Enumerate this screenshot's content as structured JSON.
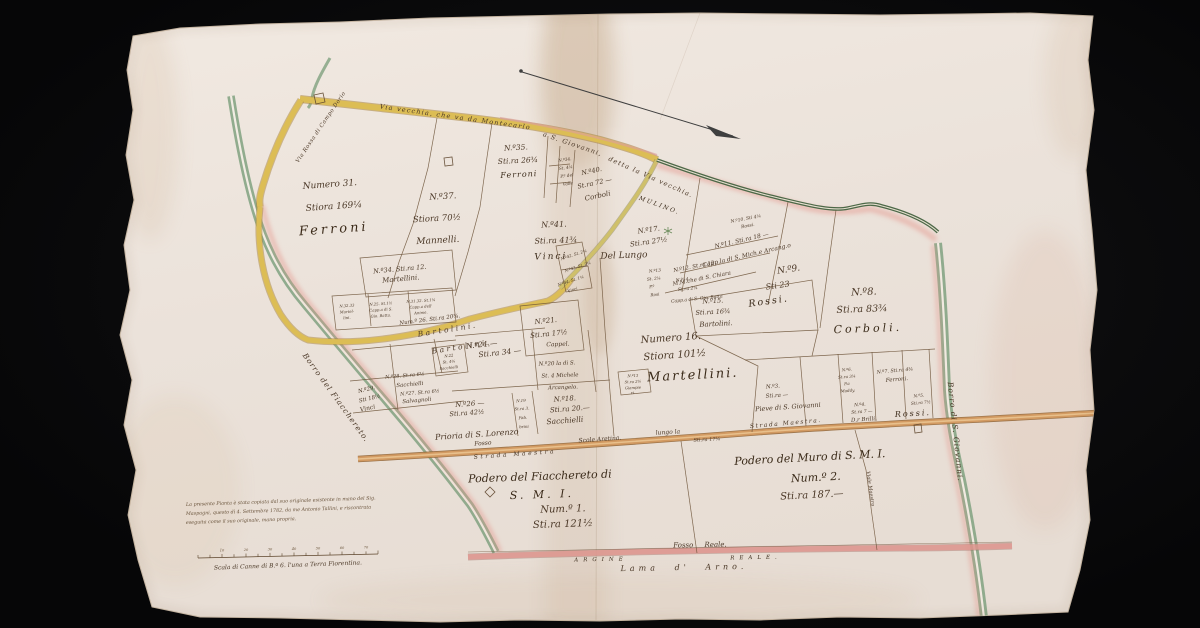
{
  "palette": {
    "background": "#0a0a0b",
    "paper": "#ebe2da",
    "ink": "#4b3827",
    "road_yellow": "#d9b952",
    "road_tan": "#d29a62",
    "river_green": "#86a585",
    "boundary_pink": "#e59a90"
  },
  "roads": {
    "via_vecchia_1": "Via vecchia, che va da Montecarlo",
    "via_vecchia_2": "a S. Giovanni,",
    "via_vecchia_3": "detta la Via vecchia.",
    "via_campo": "Via Rossa di Campo Dorio",
    "mulino": "MULINO.",
    "fosso": "Fosso",
    "strada_maestra_center": "Strada Maestra",
    "scole_aretina": "Scole Aretina.",
    "lungo_la": "lungo la",
    "sti_17": "Sti.ra 17¼",
    "strada_maestra_right": "Strada Maestra.",
    "viale_maestro": "Viale Maestro",
    "fosso_reale": "Fosso Reale.",
    "argine_1": "ARGINE",
    "argine_2": "REALE.",
    "lama_d_arno": "Lama d' Arno."
  },
  "waterways": {
    "borro_fiacchereto": "Borro del Fiacchereto.",
    "borro_giovanni": "Borro di S. Giovanni."
  },
  "parcels": {
    "p31": {
      "l1": "Numero 31.",
      "l2": "Stiora 169¼",
      "l3": "Ferroni"
    },
    "p37": {
      "l1": "N.º37.",
      "l2": "Stiora 70½",
      "l3": "Mannelli."
    },
    "p35": {
      "l1": "N.º35.",
      "l2": "Sti.ra 26¾",
      "l3": "Ferroni"
    },
    "p34s": {
      "l1": "N.º34.",
      "l2": "St. 4¼",
      "l3": "P.º del",
      "l4": "Valle"
    },
    "p40": {
      "l1": "N.º40.",
      "l2": "St.ra 72 —",
      "l3": "Corboli"
    },
    "p41": {
      "l1": "N.º41.",
      "l2": "Sti.ra 41¾",
      "l3": "Vinci"
    },
    "p42": {
      "l1": "N.º42. St. 2¼",
      "l2": "N.º43. St. 2¼",
      "l3": "N.º44. St. 1¼",
      "l4": "Vinci"
    },
    "del_lungo": {
      "l1": "Del Lungo"
    },
    "p17": {
      "l1": "N.º17.",
      "l2": "Sti.ra 27½"
    },
    "p10": {
      "l1": "N.º10. Sti 4¼",
      "l2": "Rossi."
    },
    "p11": {
      "l1": "N.º11. Sti.ra 18 —",
      "l2": "Capp.la di S. Mich.e Arcang.o"
    },
    "p12": {
      "l1": "N.º12. St.ra 12.",
      "l2": "M.M.che di S. Chiara"
    },
    "p13": {
      "l1": "N.º13",
      "l2": "St. 2¼",
      "l3": "P.º",
      "l4": "Rosi"
    },
    "p14": {
      "l1": "N.º14.",
      "l2": "St.ra 2¼",
      "l3": "Capp.a di S. Gio. Batta"
    },
    "p9": {
      "l1": "N.º9.",
      "l2": "Sti 23",
      "l3": "Rossi."
    },
    "p15": {
      "l1": "N.º15.",
      "l2": "Sti.ra 16¾",
      "l3": "Bartolini."
    },
    "p16": {
      "l1": "Numero 16.",
      "l2": "Stiora 101½",
      "l3": "Martellini."
    },
    "p8": {
      "l1": "N.º8.",
      "l2": "Sti.ra 83¾",
      "l3": "Corboli."
    },
    "p34": {
      "l1": "N.º34. Sti.ra 12.",
      "l2": "Martellini."
    },
    "b3233": {
      "l1": "N.32.33",
      "l2": "Martel-",
      "l3": "lini."
    },
    "b25": {
      "l1": "N.25. St.1½",
      "l2": "Capp.a di S.",
      "l3": "Gio. Batta."
    },
    "b3132": {
      "l1": "N.31.32. St.1¼",
      "l2": "Capp.a dell'",
      "l3": "Anime."
    },
    "p26n": {
      "l1": "Num.º 26. Sti.ra 20¾."
    },
    "bartolini_1": "Bartolini.",
    "bartolini_2": "Bartolini.",
    "p29": {
      "l1": "N.º29.",
      "l2": "Sti 18½",
      "l3": "Vinci"
    },
    "p28": {
      "l1": "N.º28. St.ra 6½",
      "l2": "Sacchielli"
    },
    "p27": {
      "l1": "N.º27. St.ra 6½",
      "l2": "Salvagnoli"
    },
    "p22": {
      "l1": "N.22",
      "l2": "St. 4¾",
      "l3": "Sacchielli"
    },
    "p21": {
      "l1": "N.º21.",
      "l2": "Sti.ra 17½"
    },
    "p24": {
      "l1": "N.º24.—",
      "l2": "Sti.ra 34 —"
    },
    "p20": {
      "l1": "Cappel.",
      "l2": "N.º20 la di S.",
      "l3": "St. 4 Michele",
      "l4": "Arcangelo."
    },
    "p26": {
      "l1": "N.º26 —",
      "l2": "Sti.ra 42½",
      "l3": "Prioria di S. Lorenzo"
    },
    "p19": {
      "l1": "N.19",
      "l2": "St.ra 3.",
      "l3": "Fab.",
      "l4": "brini"
    },
    "p18": {
      "l1": "N.º18.",
      "l2": "Sti.ra 20.—",
      "l3": "Sacchielli"
    },
    "p13b": {
      "l1": "N.º13",
      "l2": "St.ra 2½",
      "l3": "Giampie",
      "l4": "ri."
    },
    "p3": {
      "l1": "N.º3.",
      "l2": "Sti.ra —",
      "l3": "Pieve di S. Giovanni"
    },
    "p6": {
      "l1": "N.º6.",
      "l2": "St.ra 3¼",
      "l3": "P.a",
      "l4": "Maddy."
    },
    "p7": {
      "l1": "N.º7. Sti.ra 4¾",
      "l2": "Ferroni."
    },
    "p5": {
      "l1": "N.º5.",
      "l2": "Sti.ra 7½"
    },
    "p4": {
      "l1": "N.º4.",
      "l2": "St.ra 7 —",
      "l3": "D.r Brilli."
    },
    "rossi_b": "Rossi."
  },
  "poderi": {
    "fiacchereto": {
      "l1": "Podero del Fiacchereto di",
      "l2": "S. M. I.",
      "l3": "Num.º 1.",
      "l4": "Sti.ra 121½"
    },
    "muro": {
      "l1": "Podero del Muro di S. M. I.",
      "l2": "Num.º 2.",
      "l3": "Sti.ra 187.—"
    }
  },
  "note": {
    "l1": "La presente Pianta è stata copiata dal suo originale esistente in mano del Sig.",
    "l2": "Maspagni, questo dì 4. Settembre 1782, da me Antonio Tallini, e riscontrata",
    "l3": "eseguita come il suo originale, mano propria."
  },
  "scale_bar": {
    "label": "Scala di Canne di B.ª 6. l'una a Terra Fiorentina.",
    "ticks": [
      "10",
      "20",
      "30",
      "40",
      "50",
      "60",
      "70"
    ]
  }
}
